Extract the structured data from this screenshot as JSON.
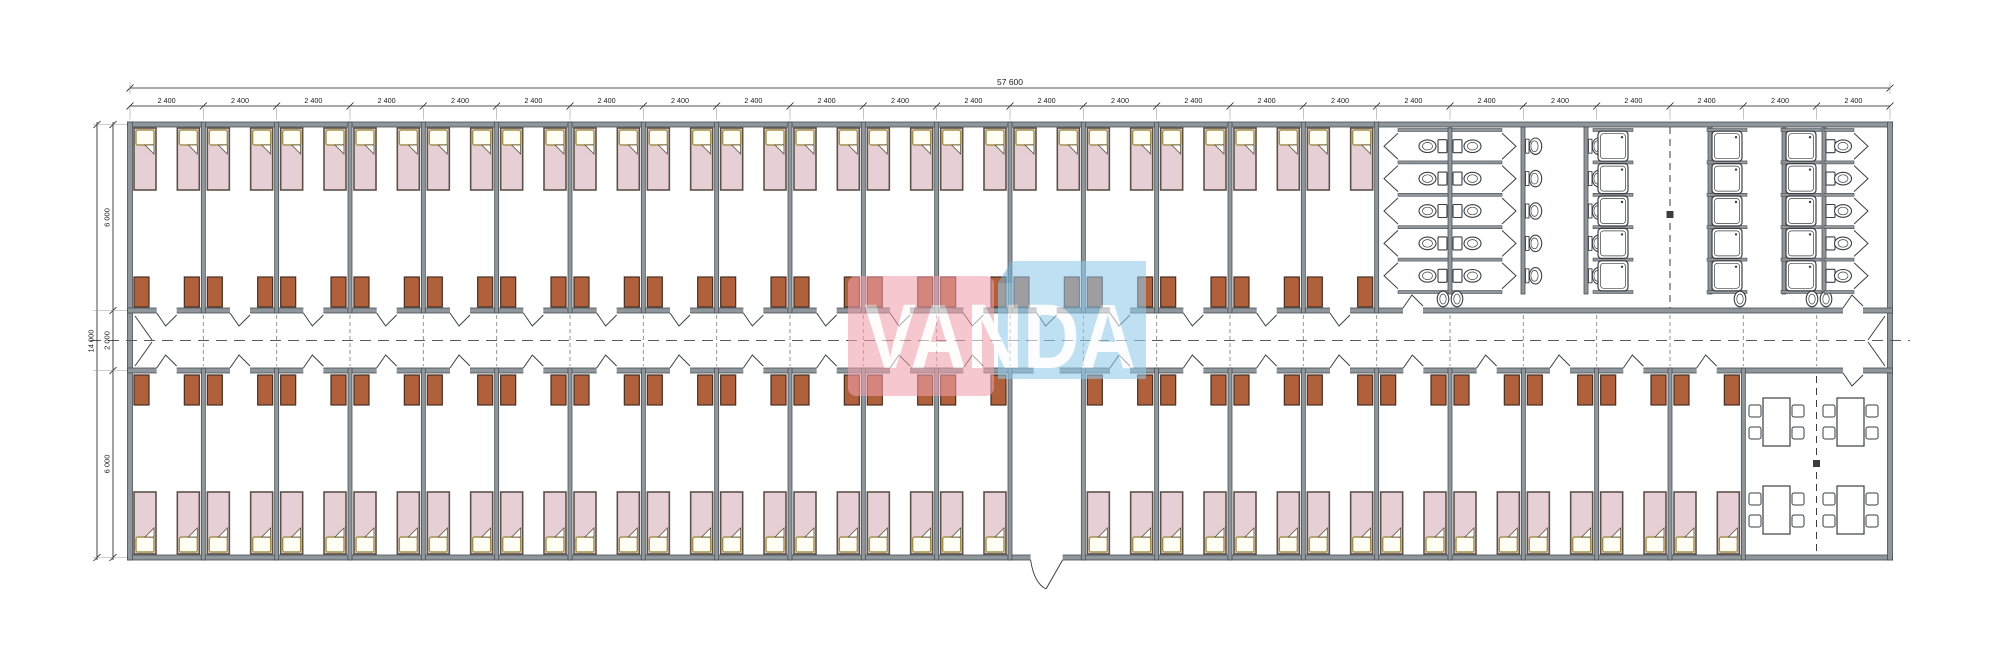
{
  "drawing": {
    "dimensions": {
      "overall_width_mm": "57 600",
      "bay_width_mm": "2 400",
      "bay_count": 24,
      "overall_depth_mm": "14 000",
      "depth_segments_mm": [
        "6 000",
        "2 000",
        "6 000"
      ]
    },
    "watermark": {
      "text": "VANDA"
    },
    "layout": {
      "top_bedroom_bays": 17,
      "bottom_bedroom_bays": 21,
      "vestibule_bay_index": 12,
      "washroom_bays": 7,
      "dining_bays": 2,
      "beds_per_bedroom": 2,
      "wardrobes_per_bedroom": 2,
      "toilet_stall_rows": 5,
      "washbasin_rows": 5,
      "shower_rows": 5,
      "shower_columns": 3,
      "right_toilet_rows": 5,
      "dining_table_count": 4,
      "chairs_per_table": 4
    },
    "colors": {
      "background": "#ffffff",
      "wall_fill": "#8f979c",
      "wall_stroke": "#494f54",
      "line": "#3a3f44",
      "fixture_fill": "#ffffff",
      "bed_fill": "#e6d0d6",
      "bed_stroke": "#5d5247",
      "pillow_fill": "#fffef4",
      "pillow_stroke": "#a3914b",
      "wardrobe_fill": "#b0603a",
      "wardrobe_stroke": "#463022",
      "dimension": "#1a1a1a",
      "witness": "#9a9a9a",
      "centerline": "#5a5a5a",
      "partition_dash": "#8a8a8a",
      "section_marker": "#3c3c3c",
      "watermark_pink": "#f0a0ab",
      "watermark_blue": "#92c9e9",
      "watermark_blue_fold": "#6fb0d8",
      "watermark_text": "#ffffff"
    }
  }
}
